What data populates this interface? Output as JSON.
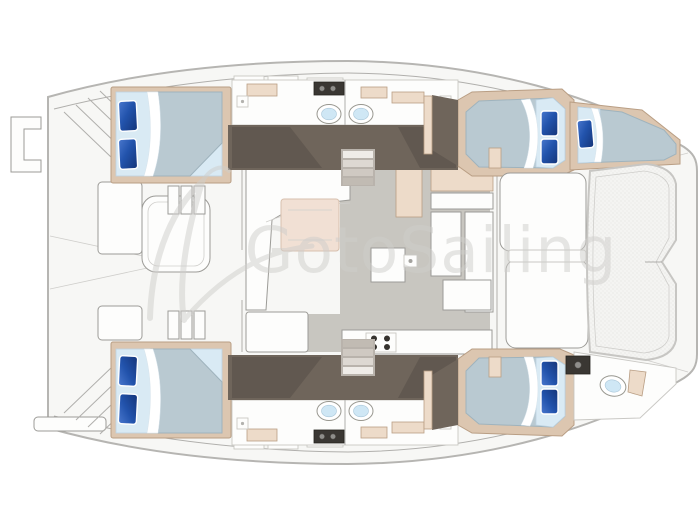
{
  "watermark": {
    "text": "GotoSailing"
  },
  "palette": {
    "white": "#fdfdfc",
    "deckFill": "#f7f7f5",
    "deckStroke": "#b6b5b2",
    "line": "#b0afac",
    "furnStroke": "#9c9b97",
    "tan": "#dcc6b0",
    "tanDark": "#b99e84",
    "tanLight": "#eddbc9",
    "dark": "#3a3733",
    "walkway": "#6f655b",
    "walkwayDark": "#554e47",
    "floor": "#c8c6c0",
    "table": "#f1e0d4",
    "tableStroke": "#d8c0ae",
    "mattress": "#b9c9d1",
    "mattressStroke": "#9fb3bd",
    "sheet": "#d9eaf4",
    "toilet": "#cfe7f5",
    "tramp": "#f4f4f2",
    "watermark": "#cfcecb"
  },
  "plan": {
    "vessel": "catamaran-floor-plan",
    "orientation": {
      "bow": "right",
      "stern": "left"
    },
    "cabins": [
      {
        "name": "port-aft-cabin",
        "bed": "double",
        "pillows": 2
      },
      {
        "name": "port-forward-cabin",
        "bed": "double",
        "pillows": 2
      },
      {
        "name": "starboard-aft-cabin",
        "bed": "double",
        "pillows": 2
      },
      {
        "name": "starboard-forward-cabin",
        "bed": "double",
        "pillows": 2
      },
      {
        "name": "bow-crew-berth",
        "bed": "single",
        "pillows": 1
      }
    ],
    "heads": [
      {
        "name": "port-aft-head",
        "toilet": true
      },
      {
        "name": "port-forward-head",
        "toilet": true
      },
      {
        "name": "starboard-aft-head",
        "toilet": true
      },
      {
        "name": "starboard-forward-head",
        "toilet": true
      },
      {
        "name": "bow-head",
        "toilet": true
      }
    ],
    "saloon": {
      "sofa": "U-shaped",
      "table": true,
      "galley": {
        "stove_burners": 4,
        "sink": true
      }
    },
    "cockpit": {
      "table": true,
      "benches": 2,
      "step_louvers": 2
    },
    "foredeck": {
      "loungers": 2
    },
    "trampoline": true,
    "stern": {
      "davit_bracket": true,
      "swim_platform": true,
      "transom_steps": 2
    }
  }
}
